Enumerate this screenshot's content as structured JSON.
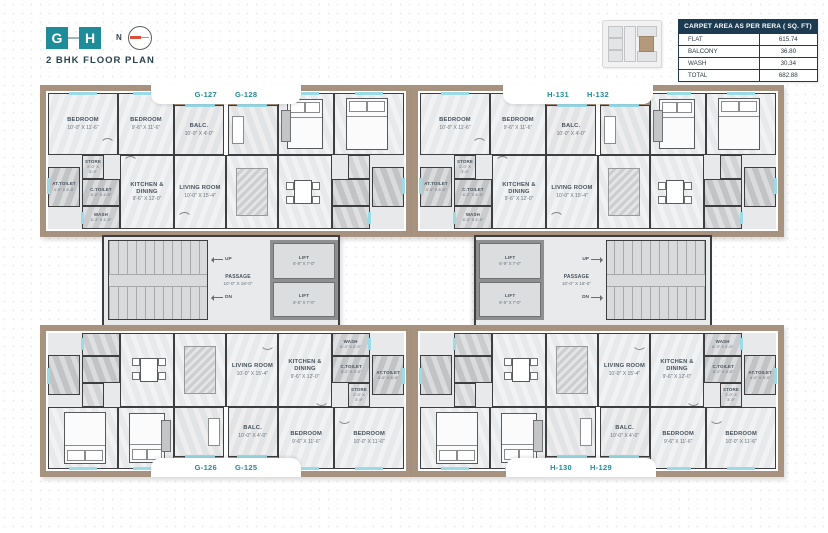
{
  "header": {
    "logo_letters": [
      "G",
      "H"
    ],
    "north_label": "N",
    "title": "2 BHK FLOOR PLAN"
  },
  "area_table": {
    "title": "CARPET AREA AS PER RERA ( SQ. FT)",
    "rows": [
      {
        "label": "FLAT",
        "value": "615.74"
      },
      {
        "label": "BALCONY",
        "value": "36.80"
      },
      {
        "label": "WASH",
        "value": "30.34"
      },
      {
        "label": "TOTAL",
        "value": "682.88"
      }
    ]
  },
  "unit_tabs": {
    "g_top": [
      "G-127",
      "G-128"
    ],
    "h_top": [
      "H-131",
      "H-132"
    ],
    "g_bottom": [
      "G-126",
      "G-125"
    ],
    "h_bottom": [
      "H-130",
      "H-129"
    ]
  },
  "rooms": {
    "bedroom1": {
      "name": "BEDROOM",
      "dim": "10'-0\" X 11'-6\""
    },
    "bedroom2": {
      "name": "BEDROOM",
      "dim": "9'-6\" X 11'-6\""
    },
    "balcony": {
      "name": "BALC.",
      "dim": "10'-0\" X 4'-0\""
    },
    "living": {
      "name": "LIVING ROOM",
      "dim": "10'-0\" X 15'-4\""
    },
    "kitchen": {
      "name": "KITCHEN & DINING",
      "dim": "9'-6\" X 12'-0\""
    },
    "at_toilet": {
      "name": "AT.TOILET",
      "dim": "4'-0\" X 8'-0\""
    },
    "c_toilet": {
      "name": "C.TOILET",
      "dim": "6'-2\" X 4'-0\""
    },
    "wash": {
      "name": "WASH",
      "dim": "6'-3\" X 4'-9\""
    },
    "store": {
      "name": "STORE",
      "dim": "2'-0\" X 3'-9\""
    }
  },
  "core": {
    "passage": {
      "name": "PASSAGE",
      "dim": "10'-0\" X 16'-0\""
    },
    "lift": {
      "name": "LIFT",
      "dim": "6'-9\" X 7'-0\""
    },
    "up_label": "UP",
    "down_label": "DN"
  },
  "colors": {
    "accent_teal": "#1f8c9a",
    "navy": "#1d3b50",
    "wall": "#3e3e40",
    "outer_band_tan": "#a6927e",
    "floor": "#e8e9eb",
    "wet_area": "#c2c3c5",
    "window_cyan": "#9adbe8",
    "compass_needle_red": "#d9503c"
  }
}
